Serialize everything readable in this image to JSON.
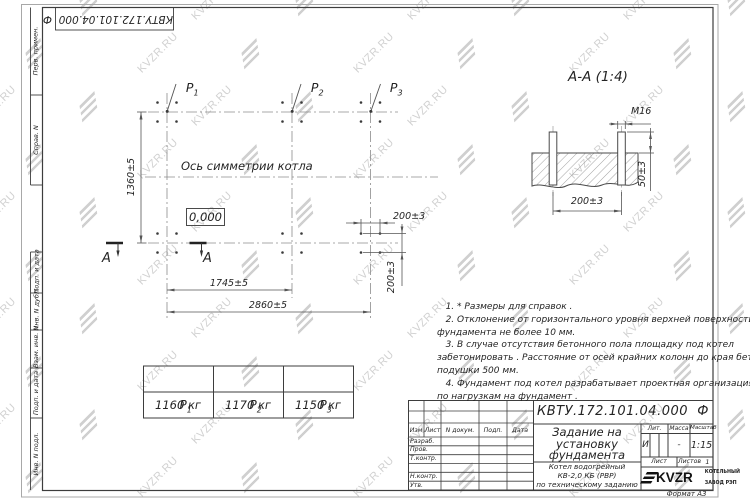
{
  "watermark": {
    "text": "KVZR.RU"
  },
  "side_strip": {
    "labels": [
      "Перв. примен.",
      "Справ. N",
      "Подп. и дата",
      "Инв. N дубл.",
      "Взам. инв. N",
      "Подп. и дата",
      "Инв. N подл."
    ]
  },
  "plan": {
    "loads": [
      {
        "name": "P",
        "sub": "1"
      },
      {
        "name": "P",
        "sub": "2"
      },
      {
        "name": "P",
        "sub": "3"
      }
    ],
    "axis_label": "Ось симметрии котла",
    "level_mark": "0,000",
    "dim_height": "1360±5",
    "dim_p1_p2": "1745±5",
    "dim_total": "2860±5",
    "dim_bolt_horizontal": "200±3",
    "dim_bolt_vertical": "200±3",
    "section_letter_left": "А",
    "section_letter_right": "А"
  },
  "section": {
    "title": "А-А (1:4)",
    "bolt_callout": "М16",
    "dim_protrusion": "50±3",
    "dim_spacing": "200±3"
  },
  "notes": {
    "lines": [
      "   1. * Размеры для справок .",
      "   2. Отклонение от горизонтального уровня верхней поверхности",
      "фундамента не более 10 мм.",
      "   3. В случае отсутствия бетонного пола площадку под котел",
      "забетонировать . Расстояние от осей крайних колонн до края бетонной",
      "подушки 500 мм.",
      "   4. Фундамент под котел разрабатывает проектная организация",
      "по нагрузкам на фундамент ."
    ]
  },
  "load_table": {
    "headers": [
      {
        "name": "P",
        "sub": "1"
      },
      {
        "name": "P",
        "sub": "2"
      },
      {
        "name": "P",
        "sub": "3"
      }
    ],
    "values": [
      "1160 кг",
      "1170 кг",
      "1150 кг"
    ]
  },
  "title_block": {
    "designation": "КВТУ.172.101.04.000  Ф",
    "title_lines": [
      "Задание на",
      "установку",
      "фундамента"
    ],
    "subtitle_lines": [
      "Котел водогрейный",
      "КВ-2,0 КБ (РВР)",
      "по техническому заданию"
    ],
    "rev_headers": [
      "Изм",
      "Лист",
      "N докум.",
      "Подп.",
      "Дата"
    ],
    "row_labels": [
      "Разраб.",
      "Пров.",
      "Т.контр.",
      "",
      "Н.контр.",
      "Утв."
    ],
    "lit_header": "Лит.",
    "lit_value": "И",
    "mass_header": "Масса",
    "mass_value": "-",
    "scale_header": "Масштаб",
    "scale_value": "1:15",
    "sheet_label": "Лист",
    "sheets_label": "Листов",
    "sheets_value": "1",
    "logo_text": "KVZR",
    "factory_line1": "КОТЕЛЬНЫЙ",
    "factory_line2": "ЗАВОД РЭП",
    "format_label": "Формат А3"
  }
}
